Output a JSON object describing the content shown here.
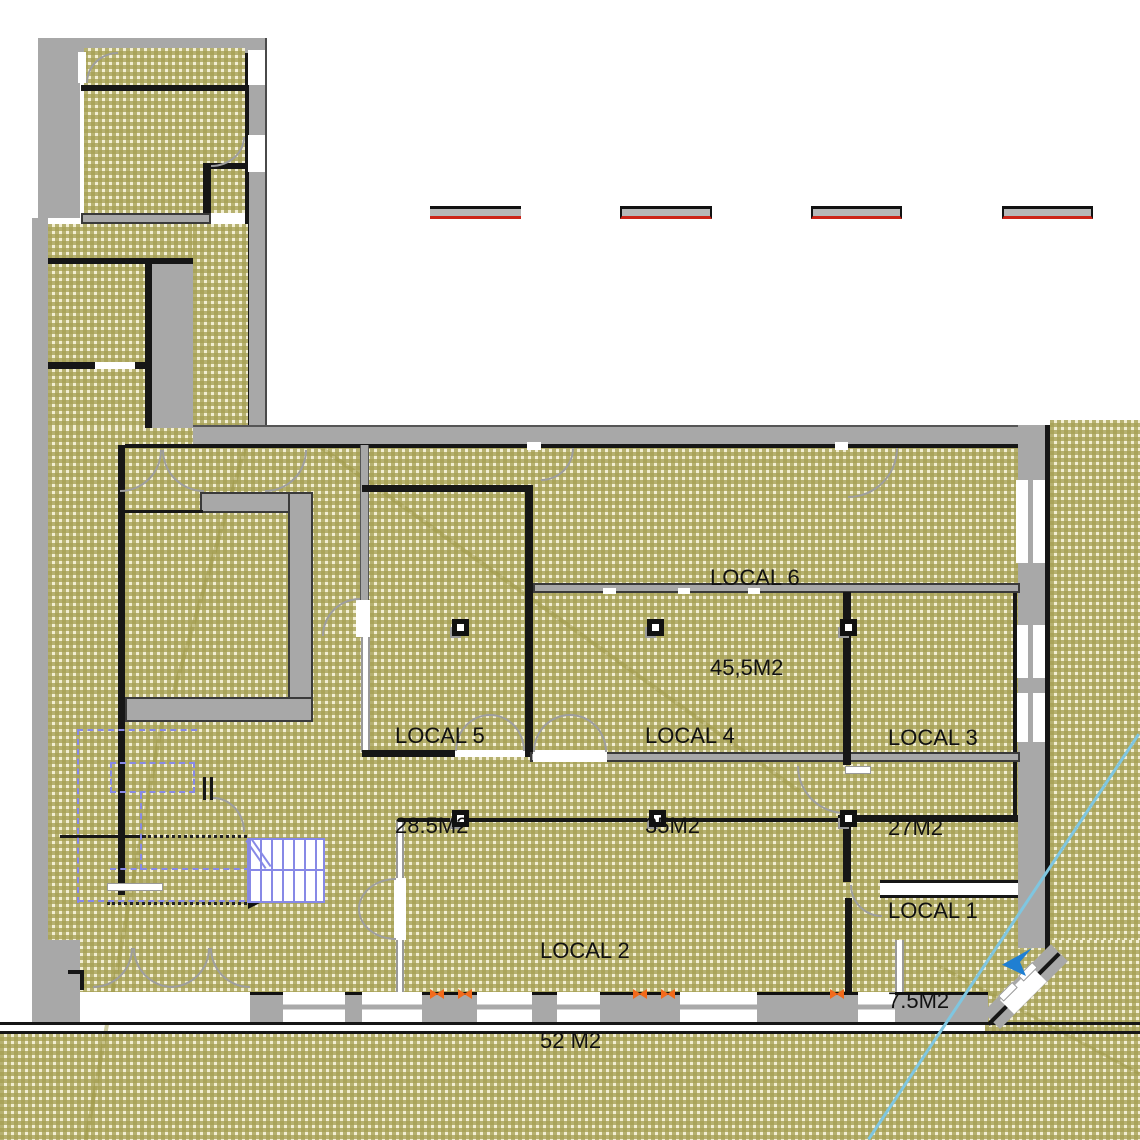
{
  "plan": {
    "rooms": [
      {
        "name": "LOCAL 6",
        "area": "45,5M2"
      },
      {
        "name": "LOCAL 5",
        "area": "28.5M2"
      },
      {
        "name": "LOCAL 4",
        "area": "35M2"
      },
      {
        "name": "LOCAL 3",
        "area": "27M2"
      },
      {
        "name": "LOCAL 2",
        "area": "52 M2"
      },
      {
        "name": "LOCAL 1",
        "area": "7.5M2"
      }
    ],
    "colors": {
      "floor_hatch_olive": "#a6a054",
      "floor_hatch_cream": "#f2eed2",
      "wall_gray": "#a8a8a8",
      "line_black": "#161616",
      "dashed_segment_red": "#cc2418",
      "window_marker_orange": "#f26a1b",
      "stair_and_dash_blue": "#8789e6",
      "boundary_cyan": "#7fc6e0",
      "entrance_arrow_blue": "#1f7fd2"
    },
    "icons": [
      "entrance-arrow-icon",
      "column-symbol",
      "door-swing-arc",
      "stairs-symbol"
    ]
  }
}
